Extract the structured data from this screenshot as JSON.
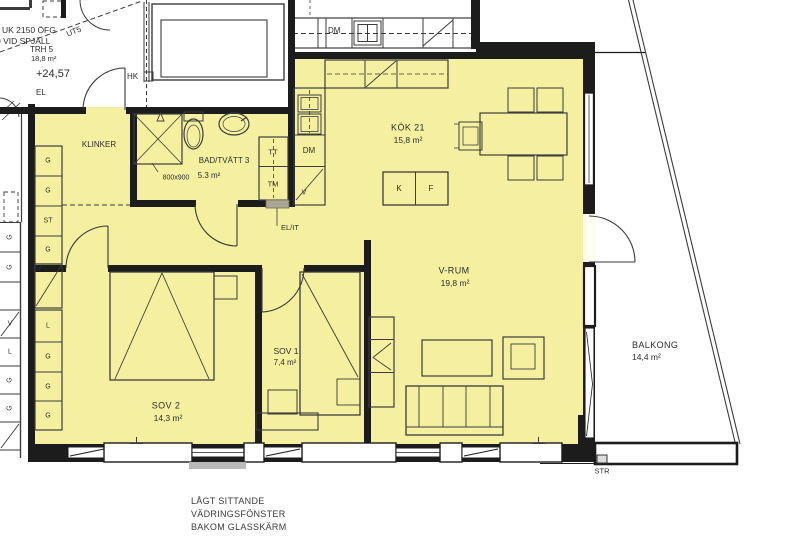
{
  "colors": {
    "apartment_fill": "#f4f0a0",
    "wall": "#1c1c1c",
    "line": "#3c3c3c",
    "gray_fixture": "#a9a694",
    "sill": "#b9b9b9"
  },
  "stairwell": {
    "note_line1": "UK 2150 ÖFG",
    "note_line2": "0 VID SPJÄLL",
    "name": "TRH 5",
    "area": "18,8 m²",
    "level": "+24,57",
    "el": "EL",
    "ut": "UT5",
    "hk": "HK"
  },
  "neighbor_kitchen": {
    "dm": "DM"
  },
  "neighbor_closets": [
    "G",
    "G",
    "V",
    "L",
    "G",
    "G"
  ],
  "hall": {
    "floor": "KLINKER",
    "closets": [
      "G",
      "G",
      "ST",
      "G"
    ],
    "tall_cabinet": "V"
  },
  "bathroom": {
    "name": "BAD/TVÄTT 3",
    "area": "5.3 m²",
    "shower_size": "800x900",
    "dryer": "TT",
    "washer": "TM",
    "el_it": "EL/IT"
  },
  "kitchen": {
    "name": "KÖK 21",
    "area": "15,8 m²",
    "dishwasher": "DM",
    "cabinet": "V",
    "fridge": "K",
    "freezer": "F"
  },
  "living": {
    "name": "V-RUM",
    "area": "19,8 m²"
  },
  "bedroom1": {
    "name": "SOV 1",
    "area": "7,4 m²"
  },
  "bedroom2": {
    "name": "SOV 2",
    "area": "14,3 m²",
    "closets": [
      "L",
      "G",
      "G",
      "G"
    ]
  },
  "balcony": {
    "name": "BALKONG",
    "area": "14,4 m²",
    "str": "STR"
  },
  "footnote": [
    "LÅGT SITTANDE",
    "VÄDRINGSFÖNSTER",
    "BAKOM GLASSKÄRM"
  ]
}
